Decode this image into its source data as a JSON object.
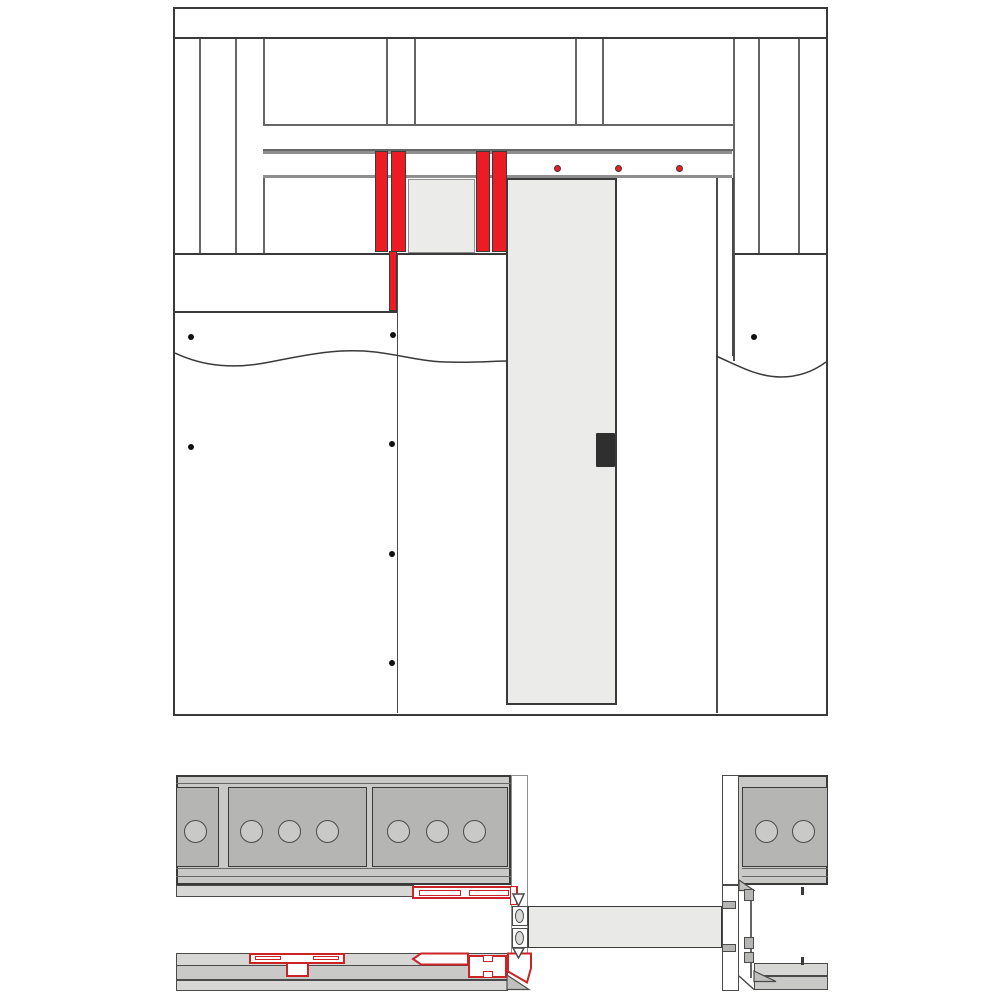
{
  "meta": {
    "drawing_type": "pocket-door-installation-detail",
    "views": [
      "frame-elevation",
      "horizontal-plan-section"
    ],
    "visible_text": ""
  },
  "colors": {
    "page_bg": "#ffffff",
    "line_dark": "#3a3a3a",
    "line_dark2": "#4a4a4a",
    "line_mid": "#8f8f8f",
    "line_mid2": "#666666",
    "red_fill": "#ed1c24",
    "red_outline": "#cc2329",
    "door_gray": "#ebebea",
    "door_plan_gray": "#e9e9e8",
    "wall_gray": "#c9c9c8",
    "panel_gray": "#b5b5b4",
    "strip_gray": "#d7d7d6",
    "wedge_gray": "#c0c0bf",
    "oval_gray": "#d9d9d8",
    "screw_dot": "#111111",
    "pull_dark": "#2f2f2f"
  },
  "elevation": {
    "track_screws": [
      {
        "x": 382.5,
        "y": 159
      },
      {
        "x": 443.5,
        "y": 159
      },
      {
        "x": 504.5,
        "y": 159
      }
    ],
    "drywall_screws": [
      {
        "x": 15.7,
        "y": 327.7
      },
      {
        "x": 217.7,
        "y": 326
      },
      {
        "x": 15.7,
        "y": 437.7
      },
      {
        "x": 217.3,
        "y": 435
      },
      {
        "x": 217.3,
        "y": 545
      },
      {
        "x": 217.3,
        "y": 653.7
      },
      {
        "x": 579.3,
        "y": 328.3
      }
    ]
  },
  "plan": {
    "circle_radius": 11.5,
    "stud_hole_circles": [
      {
        "x": 19,
        "y": 56.5
      },
      {
        "x": 75,
        "y": 56.5
      },
      {
        "x": 113.5,
        "y": 56.5
      },
      {
        "x": 151.5,
        "y": 56.5
      },
      {
        "x": 222.5,
        "y": 56.5
      },
      {
        "x": 261,
        "y": 56.5
      },
      {
        "x": 298.5,
        "y": 56.5
      },
      {
        "x": 590,
        "y": 56.5
      },
      {
        "x": 627.5,
        "y": 56.5
      }
    ]
  }
}
